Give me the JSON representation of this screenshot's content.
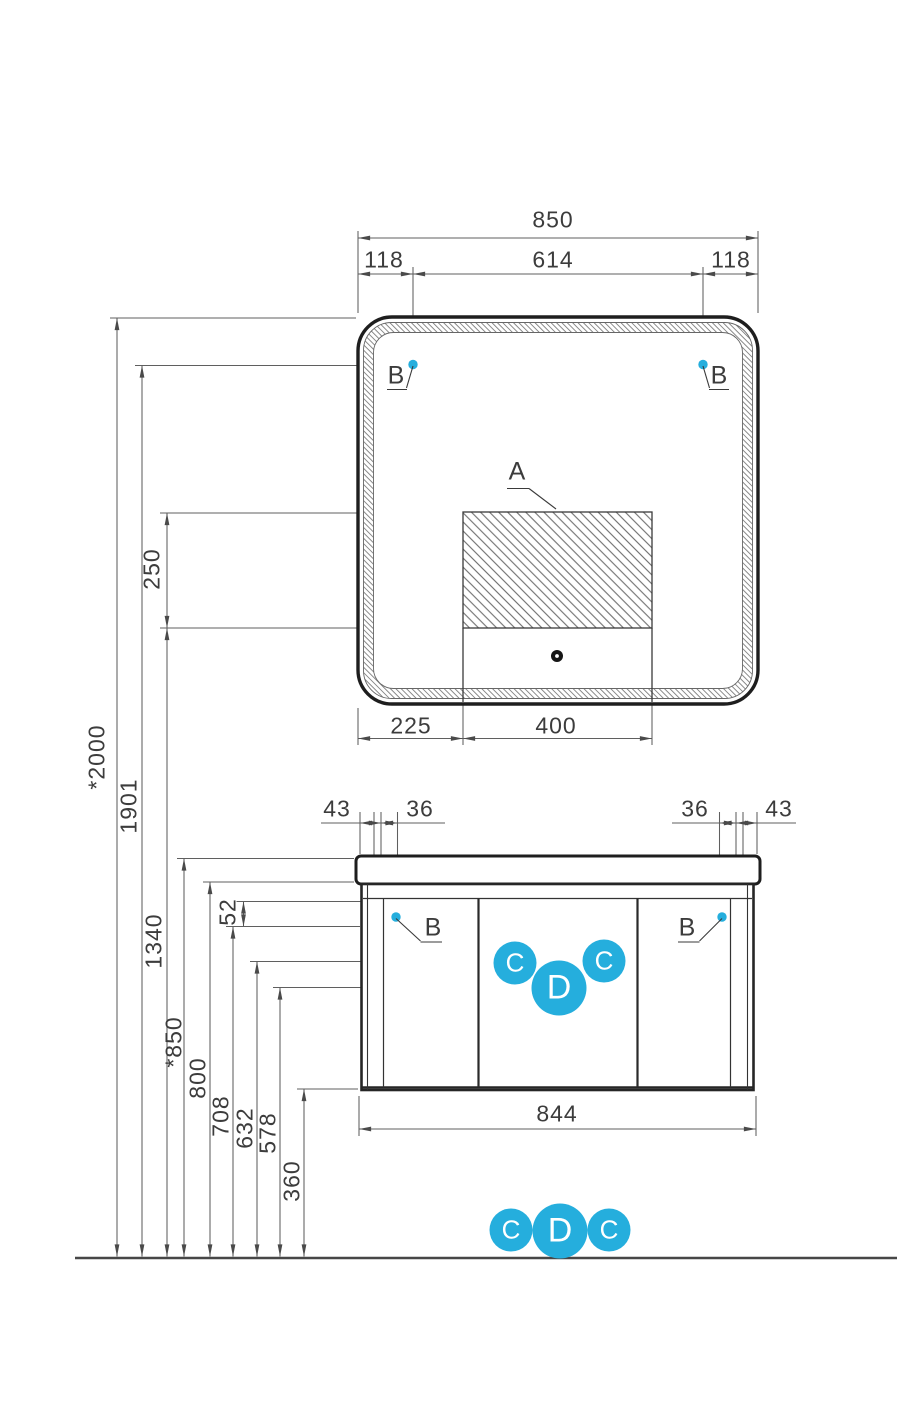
{
  "colors": {
    "accent": "#25aedd",
    "ink": "#1e1e1e",
    "dim": "#5f5f5f",
    "text": "#3c3c3c"
  },
  "drawing": {
    "mirror": {
      "width": "850",
      "offset_left": "118",
      "center_span": "614",
      "offset_right": "118",
      "bottom_left": "225",
      "bottom_center": "400",
      "panel_height": "250",
      "callout_panel": "A",
      "callout_mount": "B"
    },
    "cabinet": {
      "edge_left": "43",
      "inset_left": "36",
      "inset_right": "36",
      "edge_right": "43",
      "width": "844",
      "callout_hinge": "B",
      "badges": [
        "C",
        "D",
        "C"
      ]
    },
    "heights": {
      "total": "*2000",
      "mirror_mount": "1901",
      "panel_bottom": "1340",
      "countertop": "*850",
      "countertop_bottom": "800",
      "door_top": "708",
      "apron": "52",
      "hinge_upper": "632",
      "hinge_lower": "578",
      "cabinet_bottom": "360"
    },
    "floor_badges": [
      "C",
      "D",
      "C"
    ]
  }
}
